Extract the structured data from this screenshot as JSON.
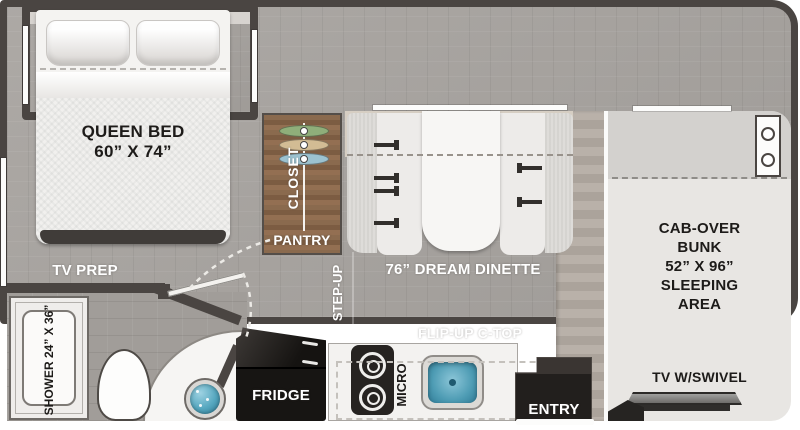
{
  "labels": {
    "queen_bed": "QUEEN BED\n60” X 74”",
    "tv_prep": "TV PREP",
    "shower": "SHOWER\n24” X 36”",
    "closet": "CLOSET",
    "pantry": "PANTRY",
    "step_up": "STEP-UP",
    "dinette": "76” DREAM DINETTE",
    "flip_up_ctop": "FLIP-UP C-TOP",
    "fridge": "FRIDGE",
    "micro": "MICRO",
    "entry": "ENTRY",
    "cab_over_bunk": "CAB-OVER\nBUNK\n52” X 96”\nSLEEPING\nAREA",
    "tv_swivel": "TV W/SWIVEL"
  },
  "colors": {
    "wall": "#4a4542",
    "carpet": "#a8a4a0",
    "closet_wood": "#85644a",
    "galley_wood": "#b3aaa2",
    "bunk_area": "#e8e6e3",
    "sink_blue": "#58aec6",
    "appliance_black": "#1b1917"
  },
  "fixtures": {
    "hangers": [
      {
        "name": "hanger-green",
        "color": "#8fae7a"
      },
      {
        "name": "hanger-tan",
        "color": "#d2bc94"
      },
      {
        "name": "hanger-blue",
        "color": "#9cc2d0"
      }
    ],
    "burner_count": 2,
    "seatbelts_left": 4,
    "seatbelts_right": 2,
    "cab_circles": 2
  }
}
